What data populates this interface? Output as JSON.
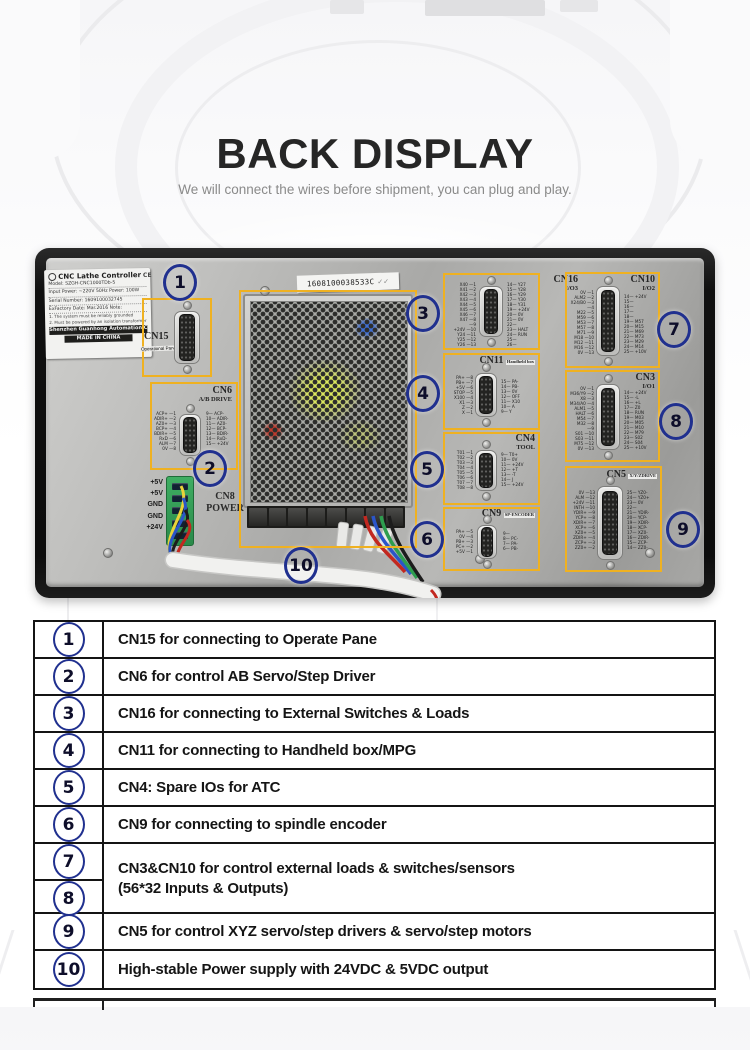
{
  "header": {
    "title": "BACK DISPLAY",
    "subtitle": "We will connect the wires before shipment, you can plug and play."
  },
  "colors": {
    "callout_blue": "#20308f",
    "box_yellow": "#efb121"
  },
  "panel": {
    "sticker": {
      "brand": "CNC Lathe Controller",
      "ce_mark": "CE",
      "lines": [
        "Model:  SZGH-CNC1000TDb-5",
        "Input Power: ~220V 50Hz  Power: 100W",
        "Serial Number: 1609100032745",
        "ExFactory Date:  Mar.2016     Note:",
        "1. The system must be reliably grounded",
        "2. Must be powered by an isolation transformer"
      ],
      "footer1": "Shenzhen Guanhong Automation Co.,Ltd",
      "footer2": "MADE IN CHINA"
    },
    "barcode": {
      "number": "1608100038533C",
      "checks": "✓✓"
    },
    "connectors": {
      "cn15": {
        "name": "CN15",
        "sub": "Operational Panel",
        "callout": "1"
      },
      "cn6": {
        "name": "CN6",
        "sub": "A/B DRIVE",
        "callout": "2",
        "pins_left": [
          "ACP+ —1",
          "ADIR+ —2",
          "AZ0+ —3",
          "BCP+ —4",
          "BDIR+ —5",
          "RxD —6",
          "ALM —7",
          "0V —8"
        ],
        "pins_right": [
          "9— ACP-",
          "10— ADIR-",
          "11— AZ0-",
          "12— BCP-",
          "13— BDIR-",
          "14— RxD-",
          "15— +24V"
        ]
      },
      "cn16": {
        "name": "CN16",
        "sub": "I/O3",
        "callout": "3",
        "pins_left": [
          "X40 —1",
          "X41 —2",
          "X42 —3",
          "X43 —4",
          "X44 —5",
          "X45 —6",
          "X46 —7",
          "X47 —8",
          "—9",
          "+24V —10",
          "Y24 —11",
          "Y25 —12",
          "Y26 —13"
        ],
        "pins_right": [
          "14— Y27",
          "15— Y28",
          "16— Y29",
          "17— Y30",
          "18— Y31",
          "19— +24V",
          "20— 0V",
          "21— 0V",
          "22—",
          "23— HALT",
          "24— RUN",
          "25—",
          "26—"
        ]
      },
      "cn11": {
        "name": "CN11",
        "sub": "Handheld box",
        "callout": "4",
        "pins_left": [
          "PA+ —8",
          "PB+ —7",
          "+5V —6",
          "STOP —5",
          "X100 —4",
          "X1 —3",
          "Z —2",
          "X —1"
        ],
        "pins_right": [
          "15— PA-",
          "14— PB-",
          "13— 0V",
          "12— OFF",
          "11— X10",
          "10— A",
          "9— Y"
        ]
      },
      "cn4": {
        "name": "CN4",
        "sub": "TOOL",
        "callout": "5",
        "pins_left": [
          "T01 —1",
          "T02 —2",
          "T03 —3",
          "T04 —4",
          "T05 —5",
          "T06 —6",
          "T07 —7",
          "T08 —8"
        ],
        "pins_right": [
          "9— T0+",
          "10— 0V",
          "11— +24V",
          "12— +T",
          "13— -T",
          "14— J",
          "15— +24V"
        ]
      },
      "cn9": {
        "name": "CN9",
        "sub": "SP-ENCODER",
        "callout": "6",
        "pins_left": [
          "PA+ —5",
          "0V —4",
          "PB+ —3",
          "PC+ —2",
          "+5V —1"
        ],
        "pins_right": [
          "9—",
          "8— PC-",
          "7— PA-",
          "6— PB-"
        ]
      },
      "cn10": {
        "name": "CN10",
        "sub": "I/O2",
        "callout": "7",
        "pins_left": [
          "0V —1",
          "ALM2 —2",
          "X24/B0 —3",
          "—4",
          "M22 —5",
          "M59 —6",
          "M53 —7",
          "M57 —8",
          "M71 —9",
          "M18 —10",
          "M12 —11",
          "M16 —12",
          "0V —13"
        ],
        "pins_right": [
          "14— +24V",
          "15—",
          "16—",
          "17—",
          "18—",
          "19— M57",
          "20— M15",
          "21— M69",
          "22— M73",
          "23— M29",
          "24— M14",
          "25— +10V"
        ]
      },
      "cn3": {
        "name": "CN3",
        "sub": "I/O1",
        "callout": "8",
        "pins_left": [
          "0V —1",
          "M36/Y9 —2",
          "X8 —3",
          "M34/A0 —4",
          "ALM1 —5",
          "HALT —6",
          "M54 —7",
          "M32 —8",
          "—9",
          "S01 —10",
          "S03 —11",
          "M75 —12",
          "0V —13"
        ],
        "pins_right": [
          "14— +24V",
          "15— -L",
          "16— +L",
          "17— Z0",
          "18— RUN",
          "19— M03",
          "20— M05",
          "21— M10",
          "22— M79",
          "23— S02",
          "24— S04",
          "25— +10V"
        ]
      },
      "cn5": {
        "name": "CN5",
        "sub": "X/Y/ZDRIVE",
        "callout": "9",
        "pins_left": [
          "0V —13",
          "ALM —12",
          "+24V —11",
          "INTH —10",
          "YDIR+ —9",
          "YCP+ —8",
          "XDIR+ —7",
          "XCP+ —6",
          "XZ0+ —5",
          "ZDIR+ —4",
          "ZCP+ —3",
          "ZZ0+ —2"
        ],
        "pins_right": [
          "25— YZ0-",
          "24— YZ0+",
          "23— 0V",
          "22—",
          "21— YDIR-",
          "20— YCP-",
          "19— XDIR-",
          "18— XCP-",
          "17— XZ0-",
          "16— ZDIR-",
          "15— ZCP-",
          "14— ZZ0-"
        ]
      },
      "cn8": {
        "name": "CN8",
        "sub": "POWER",
        "callout": "10",
        "terminals": [
          "+5V",
          "+5V",
          "GND",
          "GND",
          "+24V"
        ]
      }
    }
  },
  "legend": {
    "rows": [
      {
        "num": "1",
        "text": "CN15 for connecting to Operate Pane"
      },
      {
        "num": "2",
        "text": "CN6 for control AB Servo/Step Driver"
      },
      {
        "num": "3",
        "text": "CN16 for connecting to External Switches & Loads"
      },
      {
        "num": "4",
        "text": "CN11 for connecting to Handheld box/MPG"
      },
      {
        "num": "5",
        "text": "CN4: Spare IOs for ATC"
      },
      {
        "num": "6",
        "text": "CN9 for connecting to spindle encoder"
      },
      {
        "num_a": "7",
        "num_b": "8",
        "line1": "CN3&CN10 for control external loads & switches/sensors",
        "line2": "(56*32 Inputs & Outputs)"
      },
      {
        "num": "9",
        "text": "CN5 for control XYZ servo/step drivers & servo/step motors"
      },
      {
        "num": "10",
        "text": "High-stable Power supply with 24VDC & 5VDC output"
      }
    ]
  }
}
